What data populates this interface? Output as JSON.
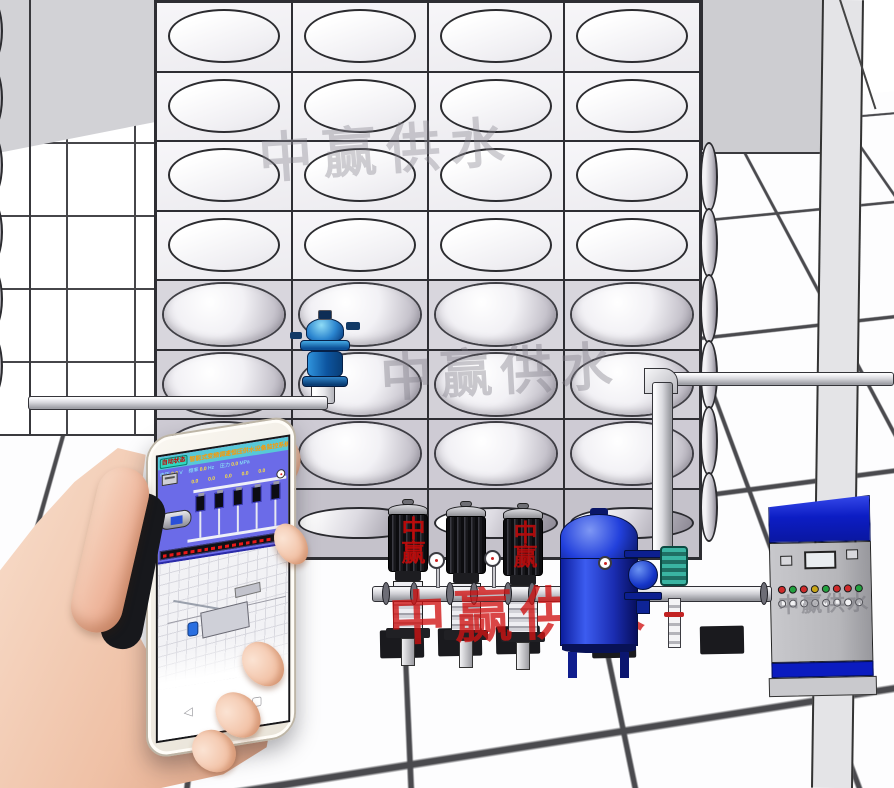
{
  "watermark": {
    "text": "中赢供水",
    "gray_color": "#8a8892",
    "red_color": "#d01212",
    "red_small_1": "中赢",
    "red_small_2": "中赢"
  },
  "tank": {
    "cols": 4,
    "rows": 8,
    "flat_rows": 4,
    "left_scallops": 6,
    "right_scallops": 6
  },
  "pump_skid": {
    "pump_count": 3,
    "flange_xs": [
      382,
      410,
      446,
      470,
      504,
      528,
      562,
      760
    ]
  },
  "pressure_tank": {
    "color": "#1b32d4"
  },
  "cabinet": {
    "watermark": "中赢供水",
    "top_color": "#0c1dc4",
    "lights_top": [
      "#cf2b2b",
      "#23a13f",
      "#cf2b2b",
      "#c8a516",
      "#23a13f",
      "#cf2b2b",
      "#cf2b2b",
      "#23a13f"
    ],
    "lights_bottom_count": 8
  },
  "phone": {
    "hmi": {
      "status_chip": "自动状态",
      "title": "智能式变频调速恒压供水设备监控系统",
      "version_tag": "(Np v1.1 A)",
      "readouts": [
        {
          "label": "电压",
          "value": "0.0",
          "unit": "V"
        },
        {
          "label": "频率",
          "value": "0.0",
          "unit": "Hz"
        },
        {
          "label": "压力",
          "value": "0.0",
          "unit": "MPa"
        }
      ],
      "pump_count": 5,
      "pump_values": [
        "0.0",
        "0.0",
        "0.0",
        "0.0",
        "0.0"
      ],
      "marquee_color": "#e81818",
      "status_dot_color": "#22dd44"
    },
    "nav": {
      "back": "◁",
      "home": "○",
      "recents": "▢"
    }
  }
}
